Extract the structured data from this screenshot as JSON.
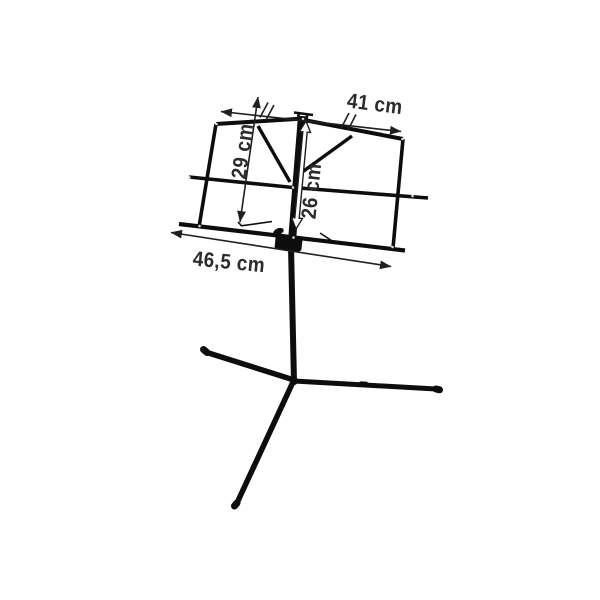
{
  "figure": {
    "subject": "folding-sheet-music-stand-with-dimensions",
    "colors": {
      "background": "#ffffff",
      "stand": "#0d0d0d",
      "dim": "#1f1f1f",
      "label": "#2b2b2b"
    },
    "labels": {
      "top_width": "41 cm",
      "desk_height": "29 cm",
      "center_height": "26 cm",
      "bottom_width": "46,5 cm"
    }
  }
}
